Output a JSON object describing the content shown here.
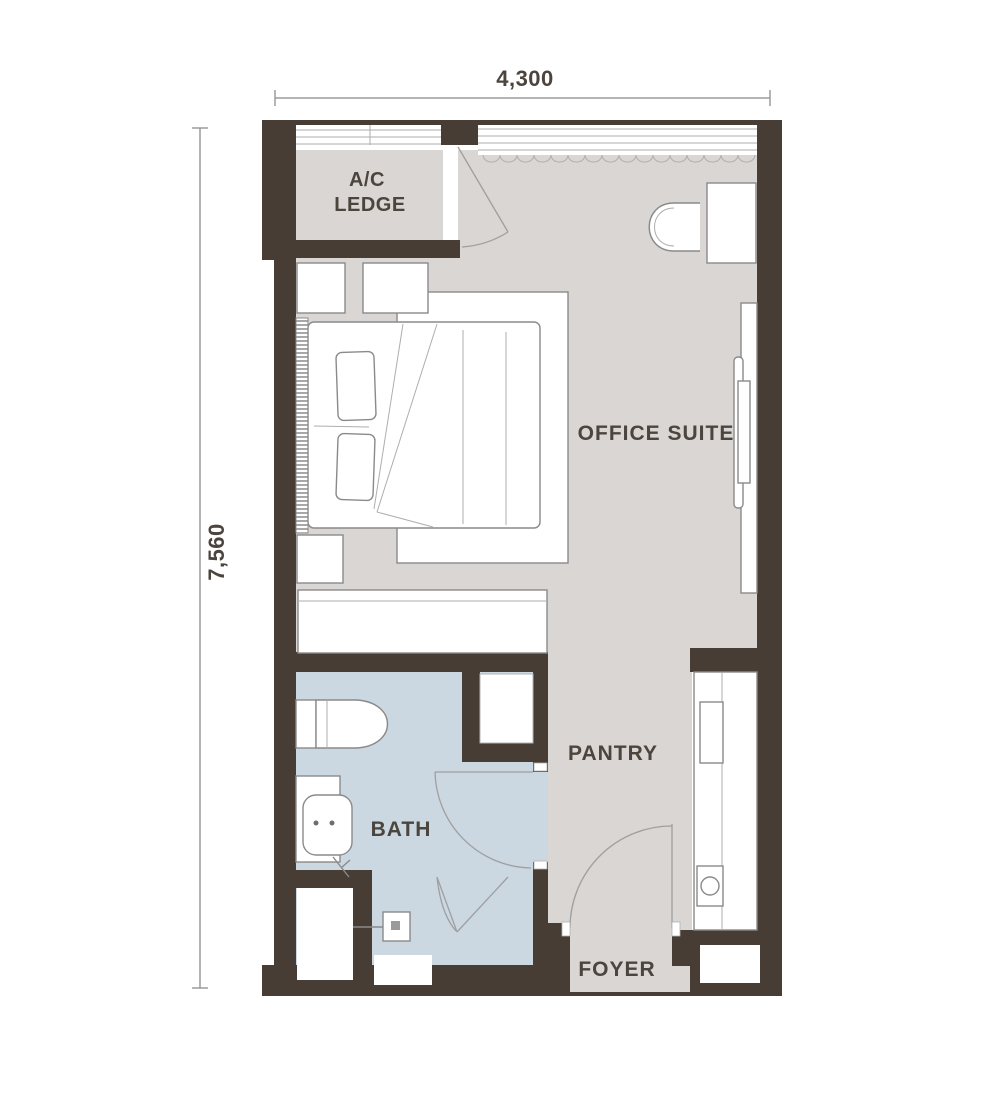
{
  "title": "Unit floor plan",
  "dimensions": {
    "top": "4,300",
    "left": "7,560"
  },
  "rooms": {
    "ac_line1": "A/C",
    "ac_line2": "LEDGE",
    "office": "OFFICE SUITE",
    "pantry": "PANTRY",
    "bath": "BATH",
    "foyer": "FOYER"
  },
  "colors": {
    "wall": "#473d35",
    "floor": "#d9d6d3",
    "bath_floor": "#cbd7e1",
    "fixture": "#ffffff",
    "line": "#8a8a8a",
    "line_light": "#aeaeae",
    "door_line": "#9f9f9f",
    "dim_line": "#9c9c9c",
    "text": "#4b453d",
    "background": "#ffffff"
  }
}
